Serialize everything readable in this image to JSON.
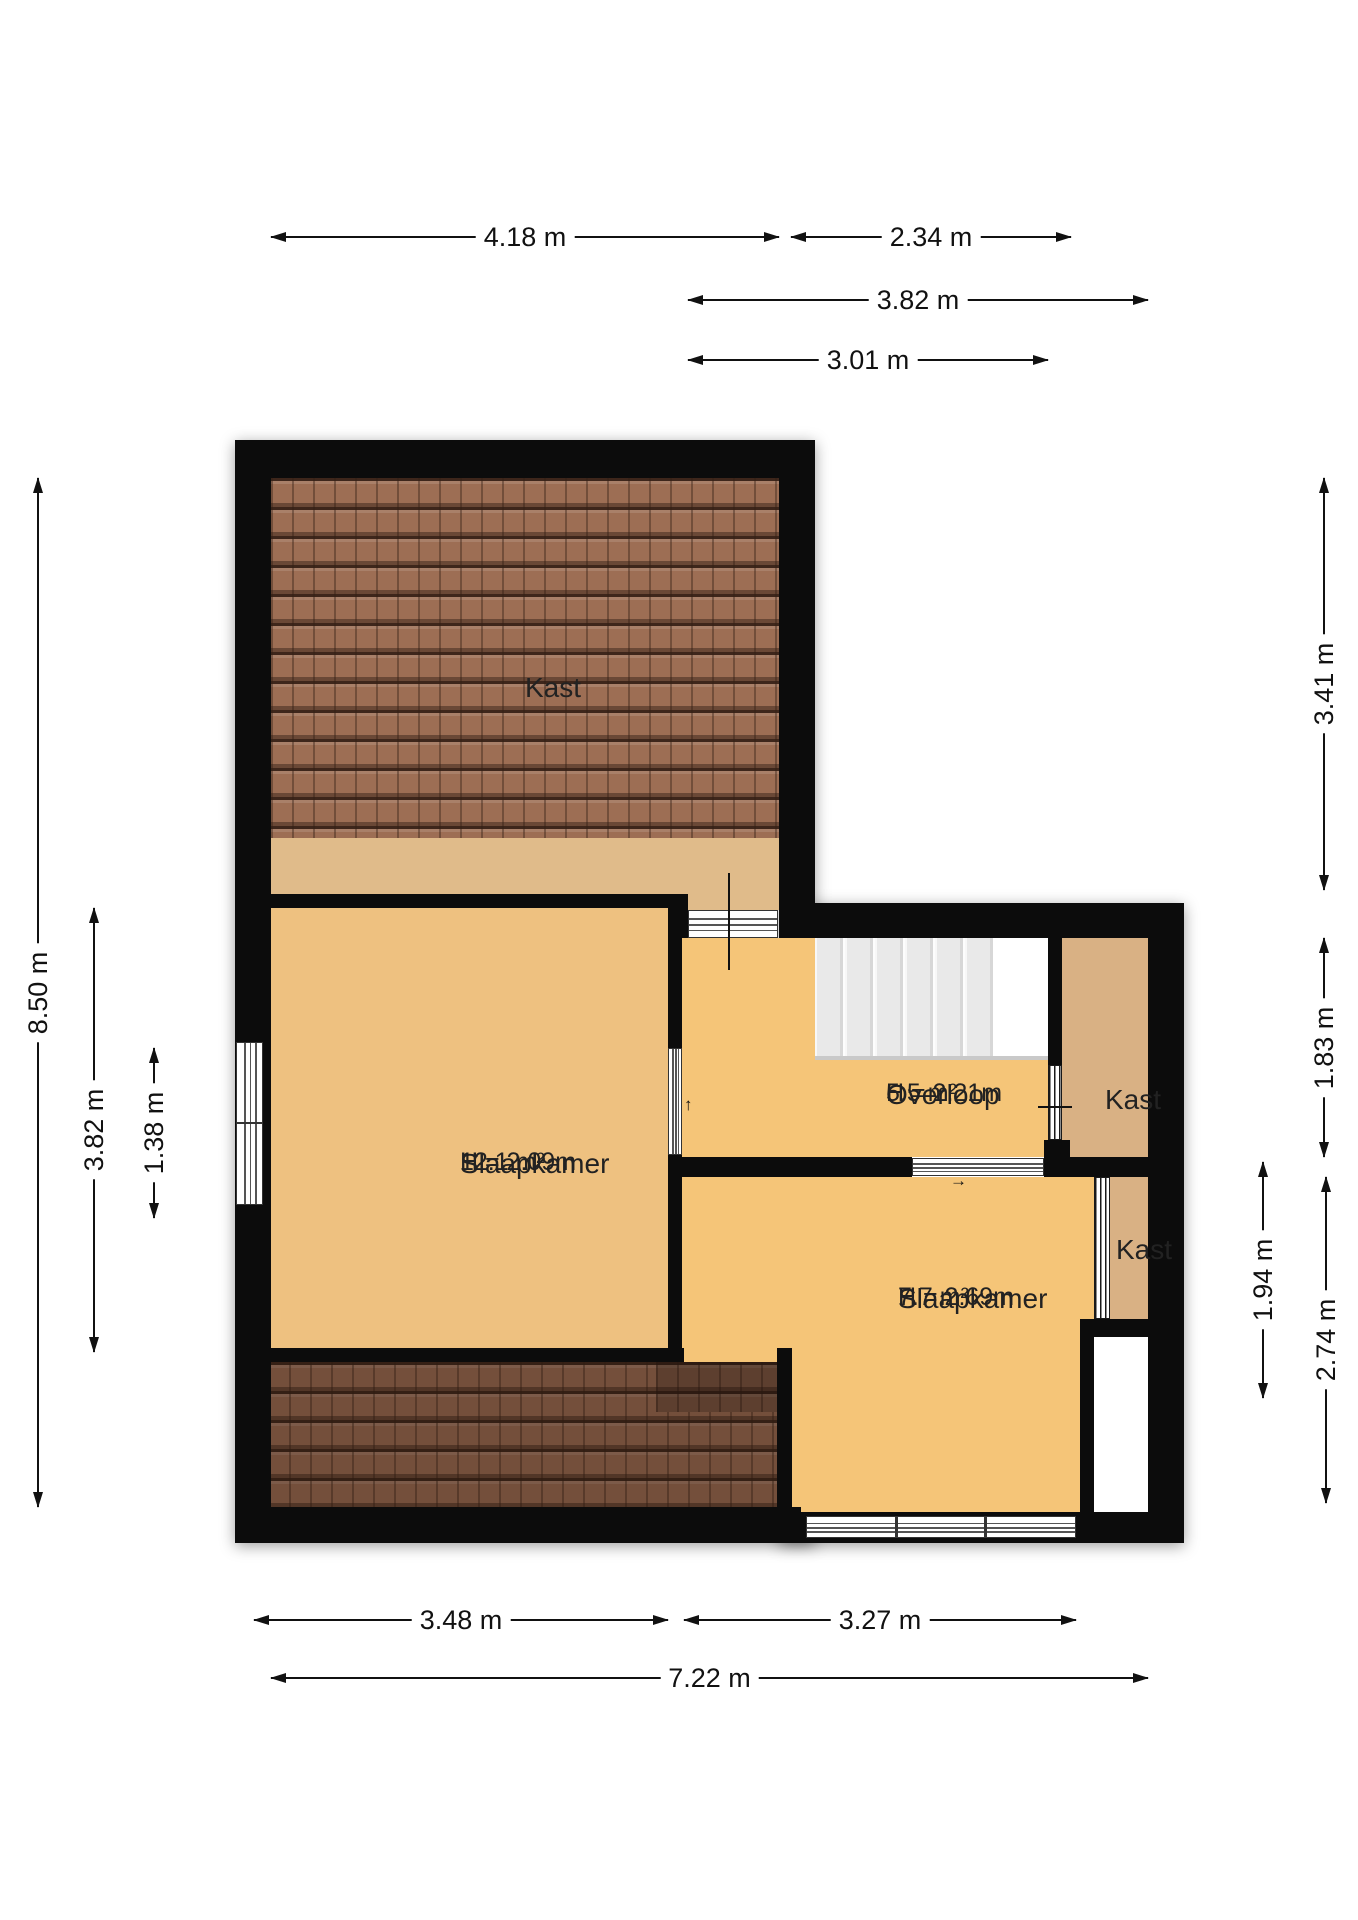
{
  "plan": {
    "canvas": {
      "w": 1358,
      "h": 1920
    },
    "colors": {
      "wall": "#0c0c0c",
      "floor_bedroom_left": "#eec180",
      "floor_orange": "#f5c578",
      "floor_closet_tan": "#d9b184",
      "floor_under_roof_strip": "#e0bb8a",
      "roof_tile": "#9d6e54",
      "stairs": "#ececec",
      "dimension_text": "#111111",
      "room_text": "#222222"
    },
    "shadows": [
      {
        "x": 235,
        "y": 440,
        "w": 580,
        "h": 1103
      },
      {
        "x": 779,
        "y": 903,
        "w": 405,
        "h": 640
      }
    ],
    "floors": [
      {
        "cls": "roof",
        "x": 271,
        "y": 478,
        "w": 508,
        "h": 360
      },
      {
        "cls": "floor-strip",
        "x": 271,
        "y": 838,
        "w": 508,
        "h": 56
      },
      {
        "cls": "floor-strip",
        "x": 684,
        "y": 894,
        "w": 95,
        "h": 16
      },
      {
        "cls": "floor-slpl",
        "x": 271,
        "y": 908,
        "w": 397,
        "h": 440
      },
      {
        "cls": "floor-orange",
        "x": 682,
        "y": 938,
        "w": 366,
        "h": 219
      },
      {
        "cls": "floor-tan",
        "x": 1062,
        "y": 938,
        "w": 86,
        "h": 219
      },
      {
        "cls": "floor-orange",
        "x": 682,
        "y": 1177,
        "w": 412,
        "h": 335
      },
      {
        "cls": "floor-tan",
        "x": 1110,
        "y": 1177,
        "w": 38,
        "h": 142
      },
      {
        "cls": "roof roof-dark",
        "x": 268,
        "y": 1362,
        "w": 509,
        "h": 145
      },
      {
        "cls": "roof roof-darker",
        "x": 656,
        "y": 1362,
        "w": 121,
        "h": 50
      },
      {
        "cls": "floor-void",
        "x": 1094,
        "y": 1337,
        "w": 54,
        "h": 171
      }
    ],
    "walls": [
      {
        "x": 235,
        "y": 440,
        "w": 36,
        "h": 1103
      },
      {
        "x": 235,
        "y": 440,
        "w": 580,
        "h": 38
      },
      {
        "x": 779,
        "y": 440,
        "w": 36,
        "h": 498
      },
      {
        "x": 779,
        "y": 903,
        "w": 405,
        "h": 35
      },
      {
        "x": 1148,
        "y": 903,
        "w": 36,
        "h": 640
      },
      {
        "x": 235,
        "y": 1507,
        "w": 566,
        "h": 36
      },
      {
        "x": 801,
        "y": 1512,
        "w": 383,
        "h": 31
      },
      {
        "x": 235,
        "y": 894,
        "w": 453,
        "h": 14
      },
      {
        "x": 668,
        "y": 894,
        "w": 20,
        "h": 44
      },
      {
        "x": 668,
        "y": 908,
        "w": 14,
        "h": 454
      },
      {
        "x": 235,
        "y": 1348,
        "w": 449,
        "h": 14
      },
      {
        "x": 777,
        "y": 1348,
        "w": 15,
        "h": 195
      },
      {
        "x": 668,
        "y": 1157,
        "w": 244,
        "h": 20
      },
      {
        "x": 1044,
        "y": 1157,
        "w": 140,
        "h": 20
      },
      {
        "x": 1048,
        "y": 938,
        "w": 14,
        "h": 127
      },
      {
        "x": 1044,
        "y": 1140,
        "w": 26,
        "h": 37
      },
      {
        "x": 1094,
        "y": 1319,
        "w": 54,
        "h": 18
      },
      {
        "x": 1080,
        "y": 1319,
        "w": 14,
        "h": 224
      }
    ],
    "stairs": {
      "x": 815,
      "y": 938,
      "w": 233,
      "h": 118,
      "tread_zone_w": 178,
      "edge_h": 4
    },
    "windows": [
      {
        "type": "v",
        "x": 236,
        "y": 1042,
        "w": 27,
        "h": 163,
        "rail": 0.49
      },
      {
        "type": "h",
        "x": 688,
        "y": 910,
        "w": 90,
        "h": 28
      },
      {
        "type": "v",
        "x": 668,
        "y": 1048,
        "w": 14,
        "h": 107
      },
      {
        "type": "h",
        "x": 912,
        "y": 1158,
        "w": 132,
        "h": 18
      },
      {
        "type": "h",
        "x": 806,
        "y": 1516,
        "w": 270,
        "h": 22,
        "mullions": [
          0.33,
          0.66
        ]
      }
    ],
    "doors": [
      {
        "x": 1048,
        "y": 1065,
        "w": 14,
        "h": 75
      },
      {
        "x": 1094,
        "y": 1177,
        "w": 16,
        "h": 142
      }
    ],
    "misc_lines": [
      {
        "x": 728,
        "y": 873,
        "w": 2,
        "h": 97
      },
      {
        "x": 1038,
        "y": 1106,
        "w": 34,
        "h": 2
      }
    ],
    "small_arrows": [
      {
        "x": 684,
        "y": 1096,
        "glyph": "↑"
      },
      {
        "x": 950,
        "y": 1172,
        "glyph": "→"
      }
    ],
    "room_labels": [
      {
        "cx": 525,
        "top": 672,
        "name": "Kast",
        "area": "",
        "height": ""
      },
      {
        "cx": 460,
        "top": 1148,
        "name": "Slaapkamer",
        "area": "12.1 m²",
        "height": "H = 2.09m"
      },
      {
        "cx": 886,
        "top": 1079,
        "name": "Overloop",
        "area": "5.5 m²",
        "height": "H = 2.21m"
      },
      {
        "cx": 1105,
        "top": 1084,
        "name": "Kast",
        "area": "",
        "height": ""
      },
      {
        "cx": 1116,
        "top": 1234,
        "name": "Kast",
        "area": "",
        "height": ""
      },
      {
        "cx": 898,
        "top": 1283,
        "name": "Slaapkamer",
        "area": "7.7 m²",
        "height": "H = 2.69m"
      }
    ],
    "dims": [
      {
        "o": "h",
        "x": 271,
        "y": 237,
        "len": 508,
        "label": "4.18 m"
      },
      {
        "o": "h",
        "x": 791,
        "y": 237,
        "len": 280,
        "label": "2.34 m"
      },
      {
        "o": "h",
        "x": 688,
        "y": 300,
        "len": 460,
        "label": "3.82 m"
      },
      {
        "o": "h",
        "x": 688,
        "y": 360,
        "len": 360,
        "label": "3.01 m"
      },
      {
        "o": "v",
        "x": 38,
        "y": 478,
        "len": 1029,
        "label": "8.50 m"
      },
      {
        "o": "v",
        "x": 94,
        "y": 908,
        "len": 444,
        "label": "3.82 m"
      },
      {
        "o": "v",
        "x": 154,
        "y": 1048,
        "len": 170,
        "label": "1.38 m"
      },
      {
        "o": "v",
        "x": 1324,
        "y": 478,
        "len": 412,
        "label": "3.41 m"
      },
      {
        "o": "v",
        "x": 1324,
        "y": 938,
        "len": 219,
        "label": "1.83 m"
      },
      {
        "o": "v",
        "x": 1263,
        "y": 1162,
        "len": 236,
        "label": "1.94 m"
      },
      {
        "o": "v",
        "x": 1326,
        "y": 1177,
        "len": 326,
        "label": "2.74 m"
      },
      {
        "o": "h",
        "x": 254,
        "y": 1620,
        "len": 414,
        "label": "3.48 m"
      },
      {
        "o": "h",
        "x": 684,
        "y": 1620,
        "len": 392,
        "label": "3.27 m"
      },
      {
        "o": "h",
        "x": 271,
        "y": 1678,
        "len": 877,
        "label": "7.22 m"
      }
    ]
  }
}
